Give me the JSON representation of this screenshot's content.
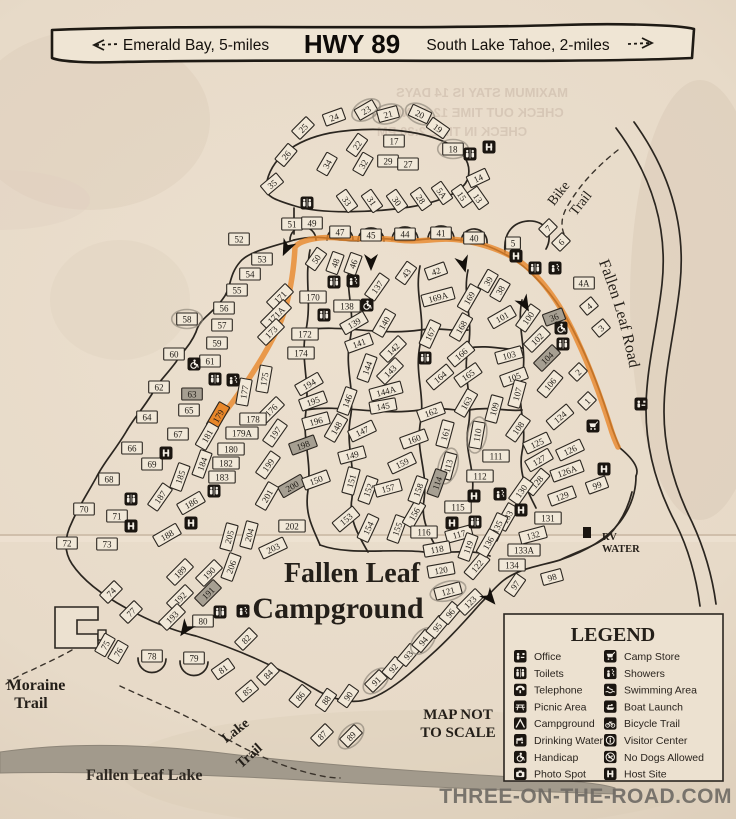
{
  "banner": {
    "left_label": "Emerald Bay, 5-miles",
    "highway": "HWY 89",
    "right_label": "South Lake Tahoe, 2-miles"
  },
  "bleed_through_lines": [
    {
      "t": "MAXIMUM STAY IS 14 DAYS",
      "x": 482,
      "y": 97
    },
    {
      "t": "CHECK OUT TIME 12:00 NOON",
      "x": 468,
      "y": 117
    },
    {
      "t": "CHECK IN TIME 2:30 PM",
      "x": 452,
      "y": 136
    }
  ],
  "map": {
    "title_line1": "Fallen Leaf",
    "title_line2": "Campground",
    "labels": {
      "bike_1": "Bike",
      "bike_2": "Trail",
      "road_label": "Fallen Leaf Road",
      "moraine_1": "Moraine",
      "moraine_2": "Trail",
      "lake_trail_1": "Lake",
      "lake_trail_2": "Trail",
      "lake_name": "Fallen Leaf Lake",
      "rv_1": "RV",
      "rv_2": "WATER",
      "scale_1": "MAP NOT",
      "scale_2": "TO SCALE"
    },
    "highlight_color": "#e8872a",
    "sites": [
      [
        "25",
        303,
        128,
        -45
      ],
      [
        "24",
        334,
        117,
        -20
      ],
      [
        "23",
        366,
        110,
        -30,
        "c"
      ],
      [
        "21",
        388,
        114,
        -15,
        "c"
      ],
      [
        "20",
        420,
        114,
        25,
        "c"
      ],
      [
        "19",
        438,
        128,
        35
      ],
      [
        "26",
        286,
        155,
        -50
      ],
      [
        "22",
        357,
        145,
        -55
      ],
      [
        "17",
        394,
        141,
        0
      ],
      [
        "18",
        453,
        149,
        0,
        "c"
      ],
      [
        "34",
        327,
        164,
        -60
      ],
      [
        "32",
        363,
        164,
        -60
      ],
      [
        "29",
        388,
        161,
        0
      ],
      [
        "27",
        408,
        164,
        0
      ],
      [
        "35",
        272,
        184,
        -40
      ],
      [
        "33",
        347,
        201,
        55
      ],
      [
        "31",
        372,
        201,
        55
      ],
      [
        "30",
        397,
        201,
        55
      ],
      [
        "28",
        421,
        199,
        55
      ],
      [
        "5A",
        442,
        193,
        55
      ],
      [
        "15",
        462,
        196,
        55
      ],
      [
        "13",
        478,
        198,
        55
      ],
      [
        "14",
        478,
        178,
        -25
      ],
      [
        "51",
        292,
        224,
        0
      ],
      [
        "49",
        312,
        223,
        0
      ],
      [
        "47",
        340,
        232,
        0
      ],
      [
        "45",
        371,
        235,
        0
      ],
      [
        "44",
        405,
        234,
        0
      ],
      [
        "41",
        441,
        233,
        0
      ],
      [
        "40",
        474,
        238,
        0
      ],
      [
        "50",
        316,
        259,
        -55
      ],
      [
        "48",
        335,
        263,
        -70
      ],
      [
        "46",
        353,
        264,
        -70
      ],
      [
        "43",
        406,
        273,
        -55
      ],
      [
        "42",
        436,
        271,
        -20
      ],
      [
        "5",
        513,
        243,
        0
      ],
      [
        "7",
        548,
        228,
        -45
      ],
      [
        "6",
        561,
        242,
        -45
      ],
      [
        "4A",
        584,
        283,
        0
      ],
      [
        "4",
        589,
        306,
        -40
      ],
      [
        "3",
        601,
        328,
        -40
      ],
      [
        "2",
        578,
        372,
        -45
      ],
      [
        "1",
        587,
        401,
        -45
      ],
      [
        "36",
        554,
        317,
        -20,
        "s"
      ],
      [
        "38",
        500,
        290,
        -60
      ],
      [
        "39",
        488,
        281,
        -60
      ],
      [
        "52",
        239,
        239,
        0
      ],
      [
        "53",
        262,
        259,
        0
      ],
      [
        "54",
        250,
        274,
        0
      ],
      [
        "55",
        237,
        290,
        0
      ],
      [
        "56",
        224,
        308,
        0
      ],
      [
        "58",
        187,
        319,
        0,
        "c"
      ],
      [
        "57",
        222,
        325,
        0
      ],
      [
        "59",
        217,
        343,
        0
      ],
      [
        "60",
        174,
        354,
        0
      ],
      [
        "61",
        210,
        361,
        0
      ],
      [
        "62",
        159,
        387,
        0
      ],
      [
        "63",
        192,
        394,
        0,
        "s"
      ],
      [
        "64",
        147,
        417,
        0
      ],
      [
        "65",
        189,
        410,
        0
      ],
      [
        "66",
        132,
        448,
        0
      ],
      [
        "67",
        178,
        434,
        0
      ],
      [
        "68",
        109,
        479,
        0
      ],
      [
        "69",
        152,
        464,
        0
      ],
      [
        "70",
        84,
        509,
        0
      ],
      [
        "71",
        117,
        516,
        0
      ],
      [
        "72",
        67,
        543,
        0
      ],
      [
        "73",
        107,
        544,
        0
      ],
      [
        "74",
        111,
        592,
        -45
      ],
      [
        "75",
        105,
        645,
        -60
      ],
      [
        "76",
        118,
        652,
        -60
      ],
      [
        "77",
        131,
        612,
        -45
      ],
      [
        "78",
        152,
        656,
        0
      ],
      [
        "79",
        194,
        658,
        0
      ],
      [
        "80",
        203,
        621,
        0
      ],
      [
        "81",
        223,
        669,
        -35
      ],
      [
        "82",
        246,
        639,
        -45
      ],
      [
        "84",
        268,
        674,
        -45
      ],
      [
        "85",
        247,
        691,
        -40
      ],
      [
        "86",
        300,
        696,
        -50
      ],
      [
        "87",
        322,
        735,
        -45
      ],
      [
        "88",
        326,
        700,
        -55
      ],
      [
        "89",
        351,
        736,
        -45,
        "c"
      ],
      [
        "90",
        348,
        696,
        -55
      ],
      [
        "91",
        376,
        681,
        -45,
        "c"
      ],
      [
        "92",
        393,
        668,
        -50
      ],
      [
        "93",
        408,
        655,
        -50
      ],
      [
        "94",
        423,
        641,
        -50,
        "c"
      ],
      [
        "95",
        437,
        627,
        -50
      ],
      [
        "96",
        450,
        613,
        -50
      ],
      [
        "170",
        313,
        297,
        0
      ],
      [
        "171",
        280,
        297,
        -45
      ],
      [
        "171A",
        276,
        315,
        -45
      ],
      [
        "173",
        271,
        332,
        -45
      ],
      [
        "172",
        305,
        334,
        0
      ],
      [
        "174",
        301,
        353,
        0
      ],
      [
        "175",
        264,
        379,
        -80
      ],
      [
        "176",
        271,
        410,
        -45
      ],
      [
        "177",
        244,
        392,
        -80
      ],
      [
        "178",
        253,
        419,
        0
      ],
      [
        "179",
        218,
        416,
        -60,
        "o"
      ],
      [
        "179A",
        242,
        433,
        0
      ],
      [
        "180",
        231,
        449,
        0
      ],
      [
        "181",
        207,
        436,
        -60
      ],
      [
        "182",
        226,
        463,
        0
      ],
      [
        "183",
        222,
        477,
        0
      ],
      [
        "184",
        202,
        464,
        -70
      ],
      [
        "185",
        180,
        477,
        -70
      ],
      [
        "186",
        191,
        503,
        -30
      ],
      [
        "187",
        160,
        497,
        -55
      ],
      [
        "188",
        167,
        535,
        -30
      ],
      [
        "189",
        180,
        572,
        -45
      ],
      [
        "190",
        209,
        573,
        -45
      ],
      [
        "191",
        208,
        593,
        -45,
        "s"
      ],
      [
        "192",
        180,
        598,
        -45
      ],
      [
        "193",
        172,
        617,
        -45
      ],
      [
        "194",
        309,
        384,
        -30
      ],
      [
        "195",
        313,
        401,
        -20
      ],
      [
        "196",
        316,
        421,
        -15
      ],
      [
        "197",
        275,
        433,
        -55
      ],
      [
        "198",
        303,
        445,
        -20,
        "s"
      ],
      [
        "199",
        268,
        465,
        -55
      ],
      [
        "200",
        292,
        486,
        -30,
        "s"
      ],
      [
        "201",
        267,
        496,
        -60
      ],
      [
        "202",
        292,
        526,
        0
      ],
      [
        "203",
        273,
        548,
        -25
      ],
      [
        "204",
        249,
        535,
        -75
      ],
      [
        "205",
        229,
        537,
        -75
      ],
      [
        "206",
        231,
        567,
        -70
      ],
      [
        "137",
        377,
        287,
        -55
      ],
      [
        "138",
        347,
        306,
        0
      ],
      [
        "139",
        354,
        323,
        -30
      ],
      [
        "140",
        384,
        323,
        -60
      ],
      [
        "141",
        359,
        343,
        -20
      ],
      [
        "142",
        393,
        349,
        -45
      ],
      [
        "143",
        390,
        371,
        -45
      ],
      [
        "144",
        367,
        368,
        -70
      ],
      [
        "144A",
        386,
        391,
        -15
      ],
      [
        "145",
        383,
        406,
        -10
      ],
      [
        "146",
        347,
        401,
        -70
      ],
      [
        "147",
        362,
        431,
        -25
      ],
      [
        "148",
        336,
        428,
        -60
      ],
      [
        "149",
        352,
        455,
        -15
      ],
      [
        "150",
        316,
        480,
        -20
      ],
      [
        "151",
        351,
        481,
        -75
      ],
      [
        "152",
        368,
        490,
        -70
      ],
      [
        "153",
        346,
        519,
        -40
      ],
      [
        "154",
        368,
        528,
        -65
      ],
      [
        "155",
        397,
        529,
        -70
      ],
      [
        "156",
        414,
        514,
        -60
      ],
      [
        "157",
        388,
        488,
        -15
      ],
      [
        "158",
        418,
        490,
        -70
      ],
      [
        "159",
        402,
        463,
        -25
      ],
      [
        "160",
        414,
        439,
        -20
      ],
      [
        "161",
        445,
        434,
        -75
      ],
      [
        "162",
        431,
        412,
        -20
      ],
      [
        "163",
        466,
        403,
        -60
      ],
      [
        "164",
        440,
        377,
        -40
      ],
      [
        "165",
        468,
        375,
        -35
      ],
      [
        "166",
        461,
        354,
        -40
      ],
      [
        "167",
        430,
        334,
        -65
      ],
      [
        "168",
        461,
        327,
        -60
      ],
      [
        "169",
        469,
        298,
        -60
      ],
      [
        "169A",
        438,
        297,
        -15
      ],
      [
        "100",
        528,
        318,
        -55
      ],
      [
        "101",
        502,
        317,
        -30
      ],
      [
        "102",
        537,
        339,
        -45
      ],
      [
        "103",
        509,
        355,
        -15
      ],
      [
        "104",
        547,
        358,
        -45,
        "s"
      ],
      [
        "105",
        514,
        377,
        -20
      ],
      [
        "106",
        550,
        384,
        -50
      ],
      [
        "107",
        517,
        394,
        -75
      ],
      [
        "108",
        518,
        428,
        -55
      ],
      [
        "109",
        494,
        409,
        -75
      ],
      [
        "110",
        477,
        435,
        -80,
        "c"
      ],
      [
        "111",
        496,
        456,
        0
      ],
      [
        "112",
        480,
        476,
        0
      ],
      [
        "113",
        448,
        466,
        -75,
        "c"
      ],
      [
        "114",
        437,
        483,
        -70,
        "s"
      ],
      [
        "115",
        458,
        507,
        0
      ],
      [
        "116",
        424,
        532,
        0
      ],
      [
        "117",
        459,
        534,
        -15
      ],
      [
        "118",
        437,
        549,
        -10
      ],
      [
        "119",
        468,
        547,
        -70
      ],
      [
        "120",
        441,
        570,
        -10
      ],
      [
        "121",
        448,
        591,
        -15,
        "c"
      ],
      [
        "122",
        477,
        566,
        -50
      ],
      [
        "123",
        470,
        602,
        -45
      ],
      [
        "124",
        560,
        417,
        -40
      ],
      [
        "125",
        537,
        443,
        -25
      ],
      [
        "126",
        570,
        450,
        -25
      ],
      [
        "126A",
        567,
        471,
        -20
      ],
      [
        "127",
        539,
        460,
        -30
      ],
      [
        "128",
        537,
        482,
        -50
      ],
      [
        "129",
        562,
        496,
        -20
      ],
      [
        "130",
        521,
        491,
        -55
      ],
      [
        "131",
        548,
        518,
        0
      ],
      [
        "132",
        533,
        535,
        -15
      ],
      [
        "133",
        507,
        517,
        -60
      ],
      [
        "133A",
        524,
        550,
        0
      ],
      [
        "134",
        512,
        565,
        0
      ],
      [
        "135",
        497,
        527,
        -65
      ],
      [
        "136",
        488,
        543,
        -60
      ],
      [
        "97",
        515,
        585,
        -55
      ],
      [
        "98",
        552,
        577,
        -15
      ],
      [
        "99",
        597,
        485,
        -20
      ]
    ],
    "icons": [
      [
        "toilets",
        470,
        154
      ],
      [
        "host",
        489,
        147
      ],
      [
        "toilets",
        307,
        203
      ],
      [
        "toilets",
        334,
        282
      ],
      [
        "shower",
        353,
        281
      ],
      [
        "handicap",
        367,
        305
      ],
      [
        "toilets",
        324,
        315
      ],
      [
        "toilets",
        215,
        379
      ],
      [
        "shower",
        233,
        380
      ],
      [
        "handicap",
        194,
        364
      ],
      [
        "toilets",
        425,
        358
      ],
      [
        "host",
        516,
        256
      ],
      [
        "toilets",
        535,
        268
      ],
      [
        "shower",
        555,
        268
      ],
      [
        "handicap",
        561,
        328
      ],
      [
        "toilets",
        563,
        344
      ],
      [
        "host",
        166,
        453
      ],
      [
        "toilets",
        131,
        499
      ],
      [
        "host",
        131,
        526
      ],
      [
        "host",
        191,
        523
      ],
      [
        "toilets",
        214,
        491
      ],
      [
        "office",
        641,
        404
      ],
      [
        "store",
        593,
        426
      ],
      [
        "host",
        604,
        469
      ],
      [
        "host",
        474,
        496
      ],
      [
        "shower",
        500,
        494
      ],
      [
        "host",
        452,
        523
      ],
      [
        "toilets",
        475,
        522
      ],
      [
        "host",
        521,
        510
      ],
      [
        "toilets",
        220,
        612
      ],
      [
        "shower",
        243,
        611
      ]
    ],
    "arrows": [
      [
        287,
        247,
        25
      ],
      [
        371,
        261,
        0
      ],
      [
        463,
        263,
        -15
      ],
      [
        524,
        303,
        -30
      ],
      [
        489,
        597,
        -40
      ],
      [
        186,
        628,
        35
      ]
    ]
  },
  "legend": {
    "title": "LEGEND",
    "items_left": [
      {
        "icon": "office",
        "label": "Office"
      },
      {
        "icon": "toilets",
        "label": "Toilets"
      },
      {
        "icon": "phone",
        "label": "Telephone"
      },
      {
        "icon": "picnic",
        "label": "Picnic Area"
      },
      {
        "icon": "tent",
        "label": "Campground"
      },
      {
        "icon": "water",
        "label": "Drinking Water"
      },
      {
        "icon": "handicap",
        "label": "Handicap"
      },
      {
        "icon": "photo",
        "label": "Photo Spot"
      }
    ],
    "items_right": [
      {
        "icon": "store",
        "label": "Camp Store"
      },
      {
        "icon": "shower",
        "label": "Showers"
      },
      {
        "icon": "swim",
        "label": "Swimming Area"
      },
      {
        "icon": "boat",
        "label": "Boat Launch"
      },
      {
        "icon": "bike",
        "label": "Bicycle Trail"
      },
      {
        "icon": "info",
        "label": "Visitor Center"
      },
      {
        "icon": "nodogs",
        "label": "No Dogs Allowed"
      },
      {
        "icon": "host",
        "label": "Host Site"
      }
    ]
  },
  "watermark": "THREE-ON-THE-ROAD.COM"
}
